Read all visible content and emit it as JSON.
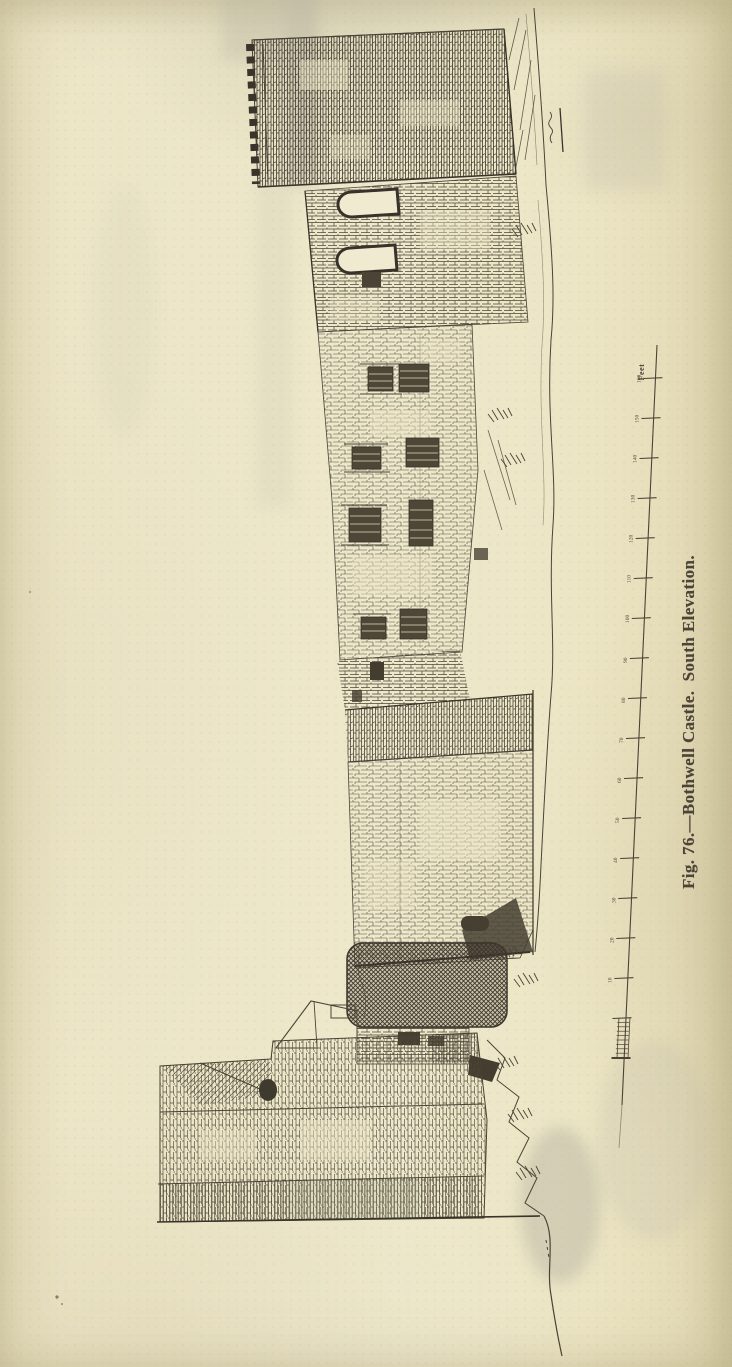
{
  "figure": {
    "caption": "Fig. 76.—Bothwell Castle.  South Elevation.",
    "figure_number": "76",
    "title": "Bothwell Castle",
    "view": "South Elevation"
  },
  "scale_bar": {
    "unit_label": "Feet",
    "tick_interval_feet": 10,
    "tick_labels": [
      "10",
      "20",
      "30",
      "40",
      "50",
      "60",
      "70",
      "80",
      "90",
      "100",
      "110",
      "120",
      "130",
      "140",
      "150",
      "160"
    ],
    "subdivided_first_interval": true
  },
  "colors": {
    "paper": "#ebe4c6",
    "ink": "#4a4336",
    "ink_dark": "#39332a",
    "show_through": "#b9b6a4"
  }
}
